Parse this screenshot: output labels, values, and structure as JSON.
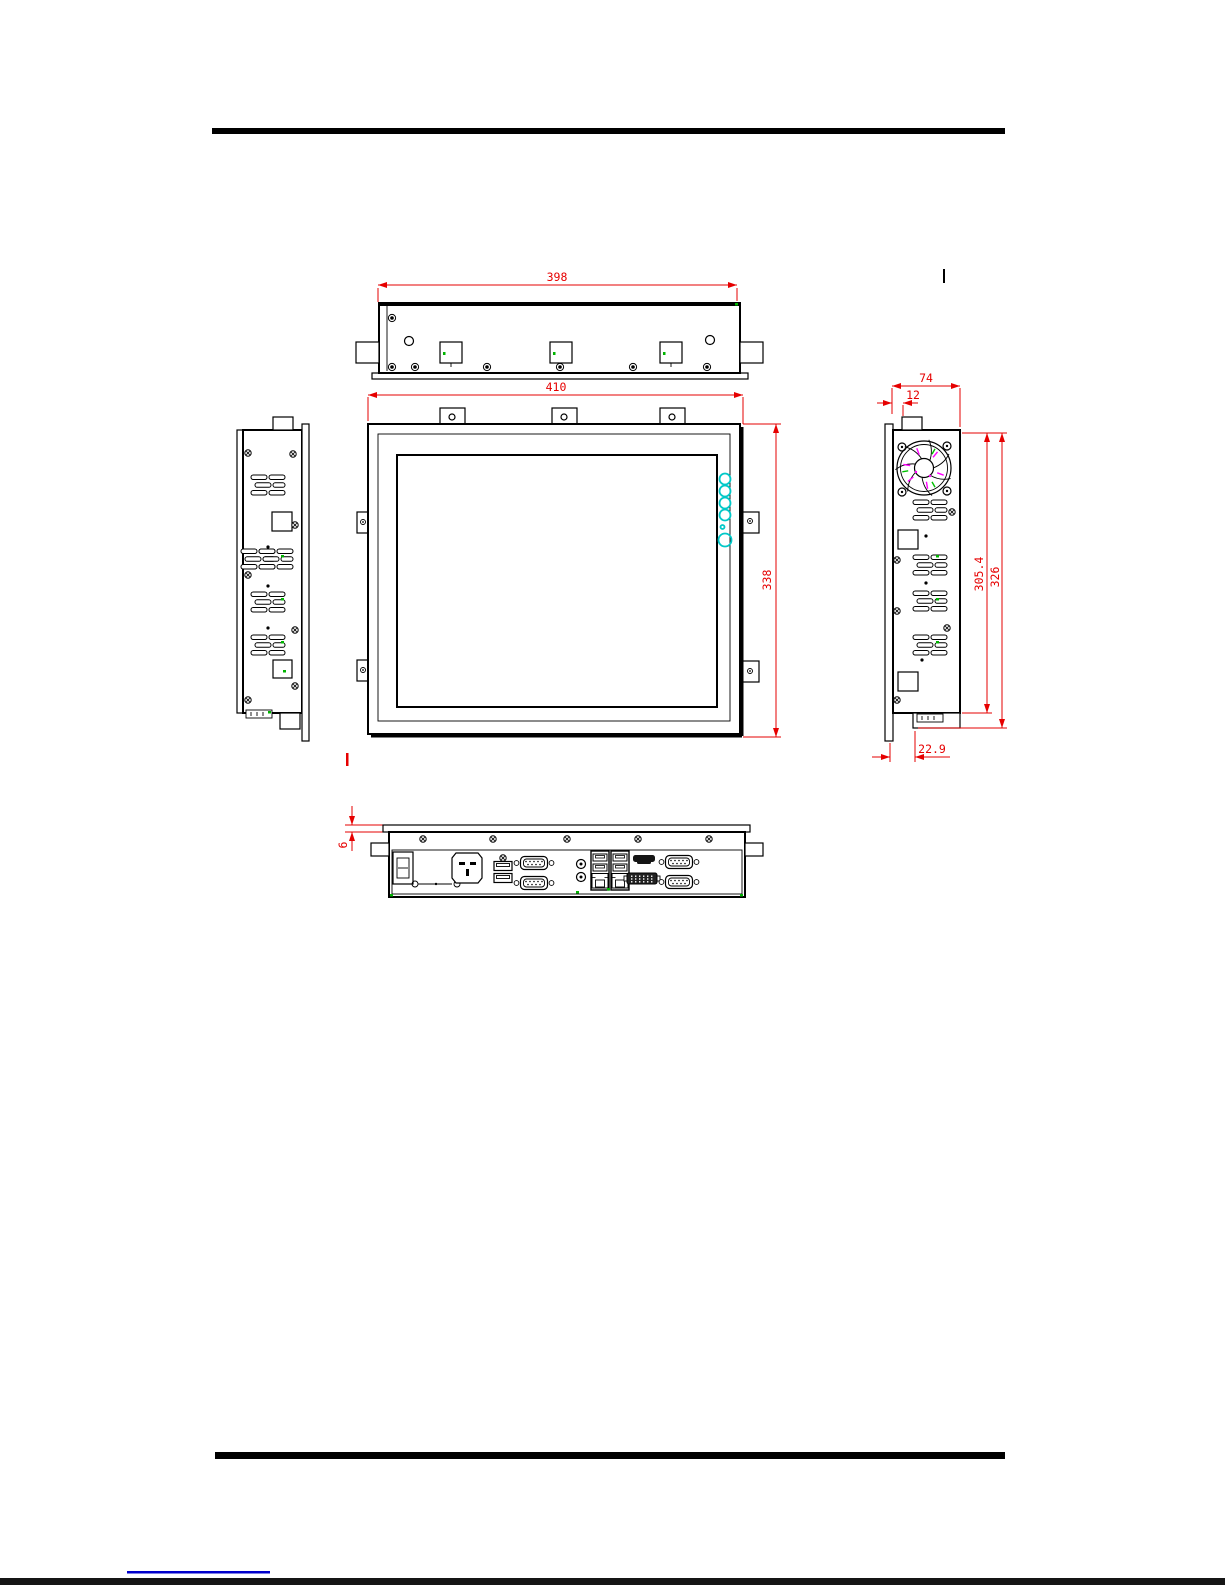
{
  "drawing": {
    "kind": "panel-pc-dimensional-drawing",
    "views": {
      "top": "top-view",
      "front": "front-view",
      "left": "left-side-view",
      "right": "right-side-view",
      "bottom": "bottom-io-view"
    }
  },
  "dimensions": {
    "top_width": "398",
    "front_width": "410",
    "front_height": "338",
    "side_depth": "74",
    "side_tab_offset": "12",
    "side_inner_height": "305.4",
    "side_outer_height": "326",
    "side_mount_depth": "22.9",
    "bezel_lip": "6"
  },
  "colors": {
    "dimension_red": "#e60000",
    "osd_cyan": "#00c8c8",
    "fan_magenta": "#ff00ff",
    "accent_green": "#00b400",
    "line_black": "#000000",
    "footer_link_blue": "#0000cc"
  },
  "ports": [
    "power-switch",
    "ac-power-inlet",
    "usb-ports",
    "com-serial-ports",
    "audio-jacks",
    "usb-lan-combo",
    "usb-lan-combo",
    "hdmi-port",
    "dvi-port",
    "com-serial-ports"
  ]
}
